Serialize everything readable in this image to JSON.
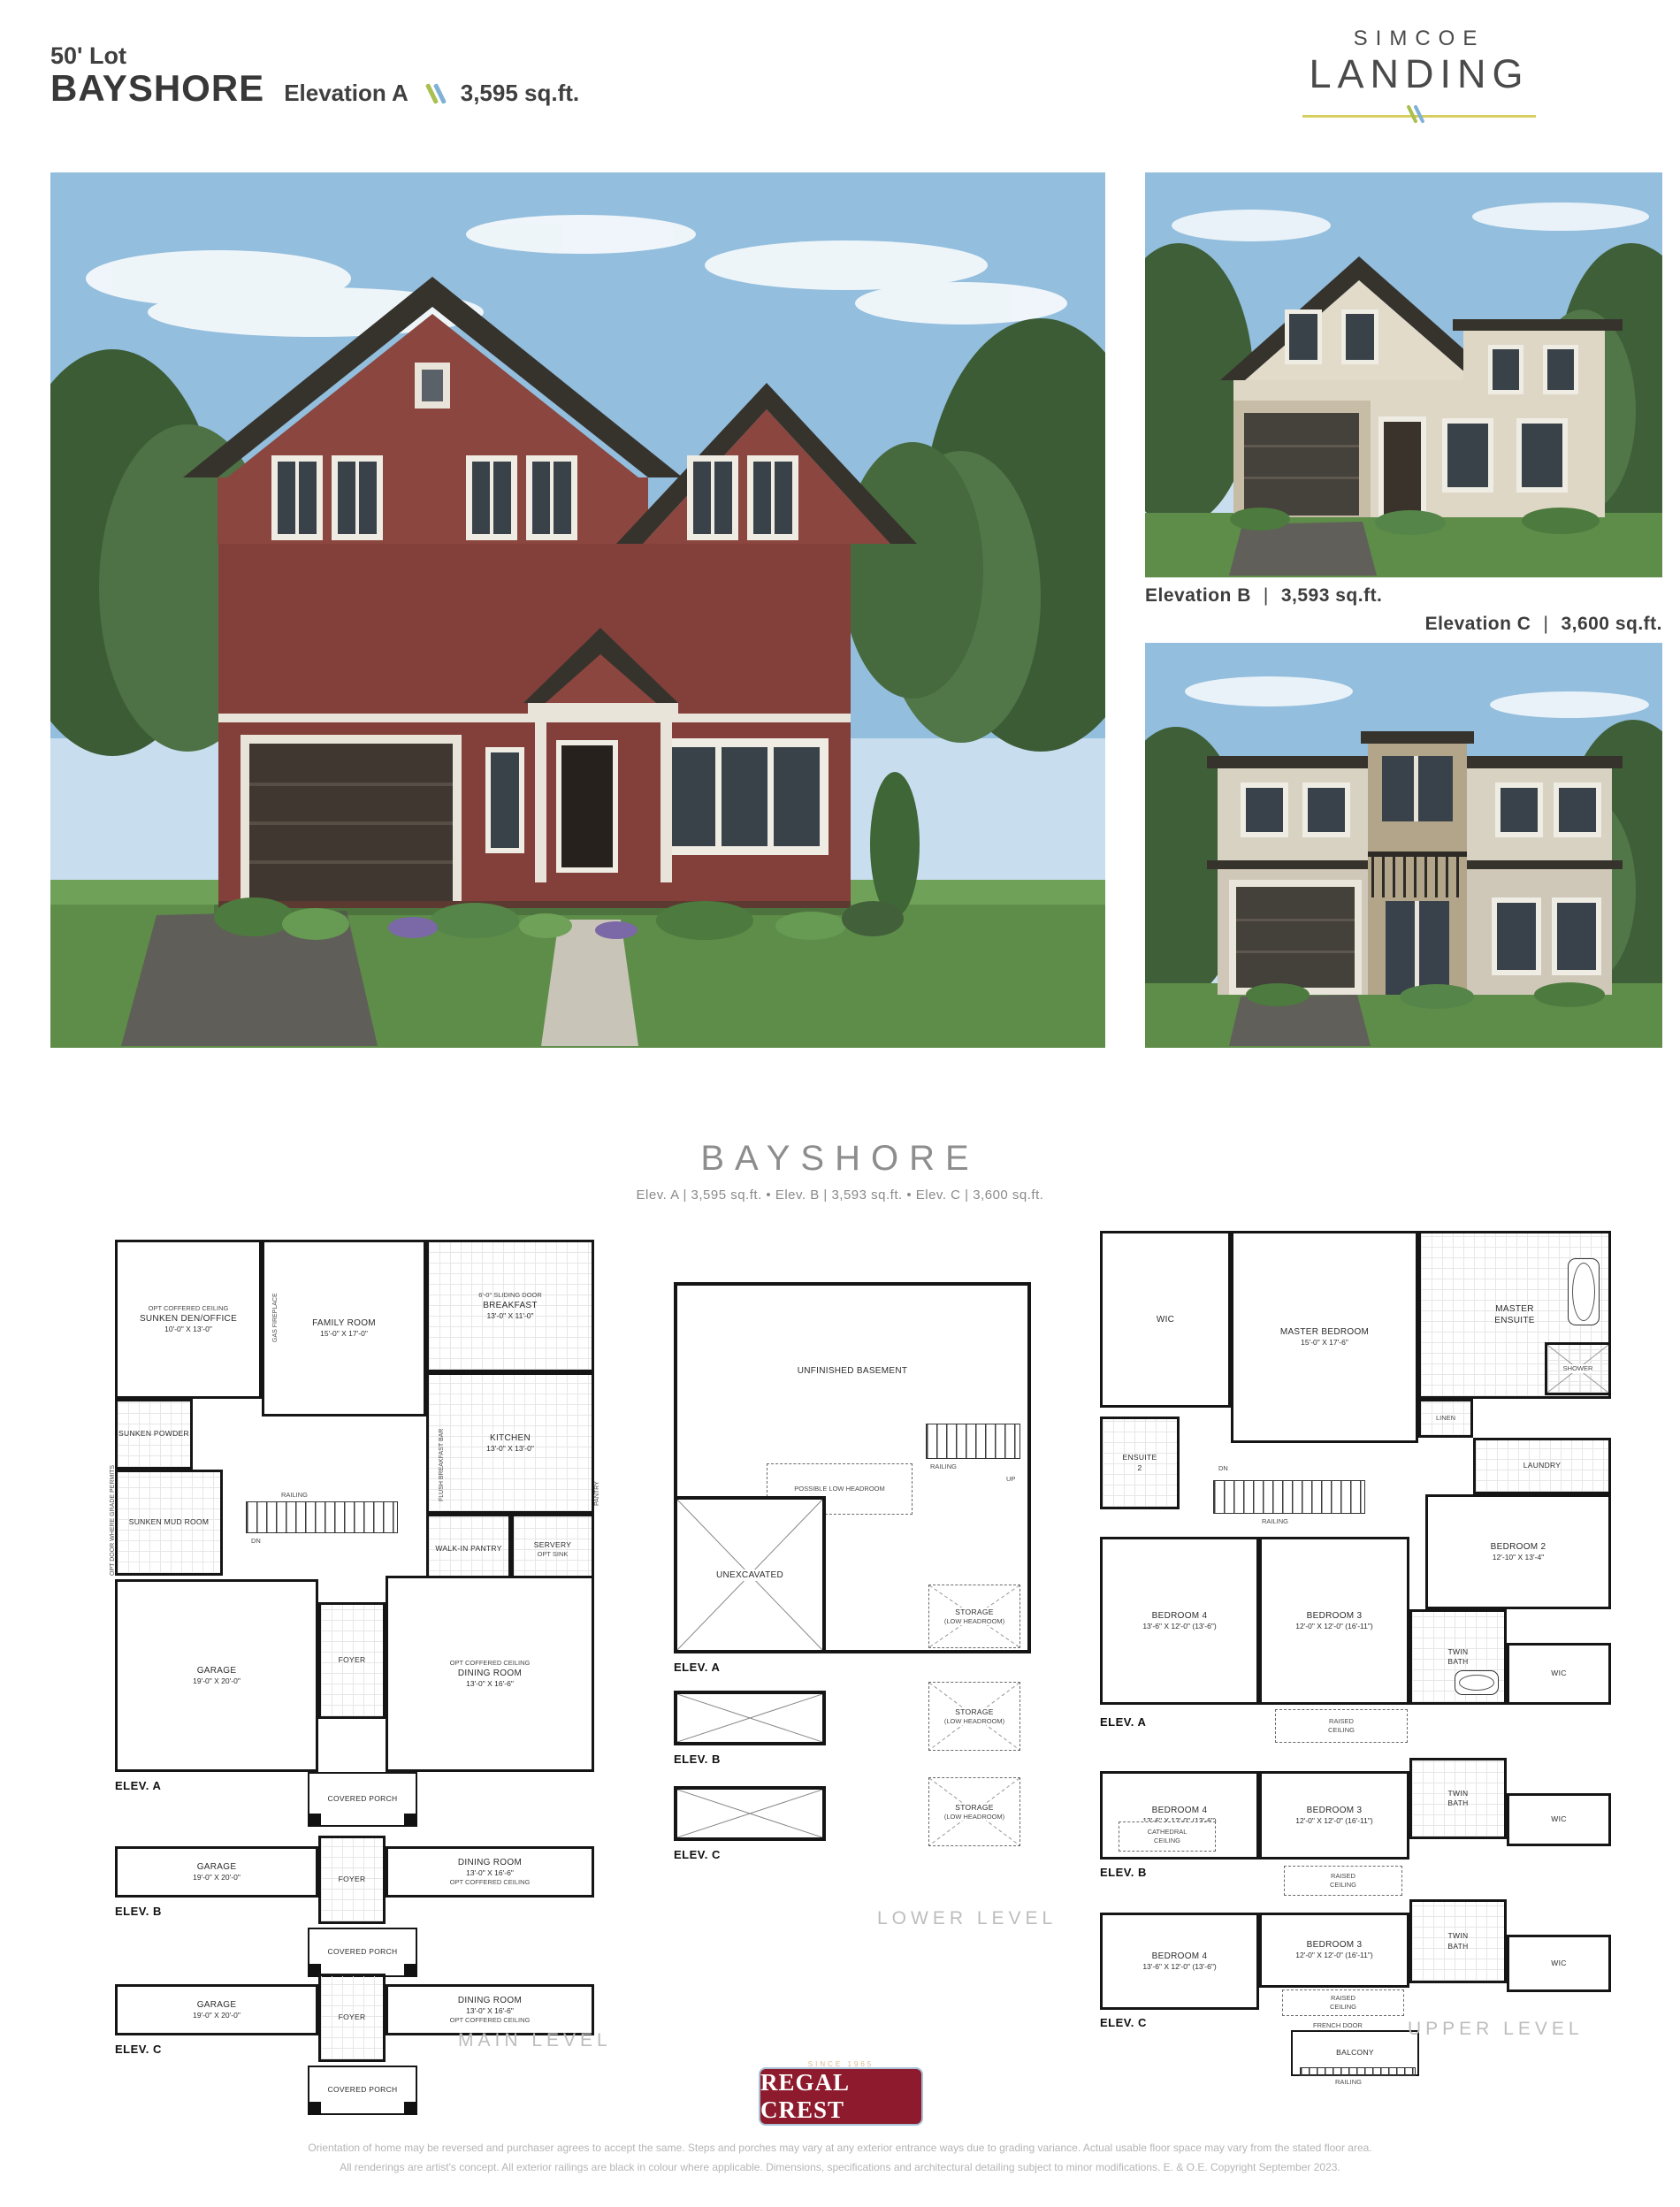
{
  "header": {
    "lot": "50' Lot",
    "model": "BAYSHORE",
    "elevation": "Elevation A",
    "sqft": "3,595 sq.ft."
  },
  "brand": {
    "top": "SIMCOE",
    "bottom": "LANDING"
  },
  "captions": {
    "b_name": "Elevation B",
    "b_sqft": "3,593 sq.ft.",
    "c_name": "Elevation C",
    "c_sqft": "3,600 sq.ft.",
    "sep": "|"
  },
  "section": {
    "title": "BAYSHORE",
    "subtitle": "Elev. A  |  3,595 sq.ft.   •   Elev. B  |  3,593 sq.ft.   •   Elev. C  |  3,600 sq.ft."
  },
  "levels": {
    "main": "MAIN LEVEL",
    "lower": "LOWER LEVEL",
    "upper": "UPPER LEVEL"
  },
  "elev_labels": {
    "a": "ELEV. A",
    "b": "ELEV. B",
    "c": "ELEV. C"
  },
  "main": {
    "den": {
      "name": "SUNKEN DEN/OFFICE",
      "dims": "10'-0\" X 13'-0\""
    },
    "family": {
      "name": "FAMILY ROOM",
      "dims": "15'-0\" X 17'-0\""
    },
    "breakfast": {
      "name": "BREAKFAST",
      "dims": "13'-0\" X 11'-0\""
    },
    "kitchen": {
      "name": "KITCHEN",
      "dims": "13'-0\" X 13'-0\""
    },
    "powder": "SUNKEN POWDER",
    "mud": "SUNKEN MUD ROOM",
    "walkin": "WALK-IN PANTRY",
    "servery": "SERVERY",
    "opt_sink": "OPT SINK",
    "pantry": "PANTRY",
    "garage": {
      "name": "GARAGE",
      "dims": "19'-0\" X 20'-0\""
    },
    "dining": {
      "name": "DINING ROOM",
      "dims": "13'-0\" X 16'-6\""
    },
    "foyer": "FOYER",
    "porch": "COVERED PORCH",
    "railing": "RAILING",
    "dn": "DN",
    "notes": {
      "coffered": "OPT COFFERED CEILING",
      "sliding": "6'-0\" SLIDING DOOR",
      "fireplace": "GAS FIREPLACE",
      "bar": "FLUSH BREAKFAST BAR",
      "door_grade": "DOOR WHERE GRADE PERMITS",
      "opt_door_grade": "OPT DOOR WHERE GRADE PERMITS"
    }
  },
  "lower": {
    "basement": "UNFINISHED BASEMENT",
    "low_head": "POSSIBLE LOW HEADROOM",
    "unexcavated": "UNEXCAVATED",
    "storage": "STORAGE",
    "storage_sub": "(LOW HEADROOM)",
    "railing": "RAILING",
    "up": "UP"
  },
  "upper": {
    "wic": "WIC",
    "master": {
      "name": "MASTER BEDROOM",
      "dims": "15'-0\" X 17'-6\""
    },
    "ensuite": {
      "line1": "MASTER",
      "line2": "ENSUITE"
    },
    "shower": "SHOWER",
    "linen": "LINEN",
    "laundry": "LAUNDRY",
    "ensuite2": {
      "line1": "ENSUITE",
      "line2": "2"
    },
    "bed2": {
      "name": "BEDROOM 2",
      "dims": "12'-10\" X 13'-4\""
    },
    "bed3": {
      "name": "BEDROOM 3",
      "dims": "12'-0\" X 12'-0\" (16'-11\")"
    },
    "bed4": {
      "name": "BEDROOM 4",
      "dims": "13'-6\" X 12'-0\" (13'-6\")"
    },
    "twin": {
      "line1": "TWIN",
      "line2": "BATH"
    },
    "raised": {
      "line1": "RAISED",
      "line2": "CEILING"
    },
    "cathedral": {
      "line1": "CATHEDRAL",
      "line2": "CEILING"
    },
    "french": "FRENCH DOOR",
    "balcony": "BALCONY",
    "railing": "RAILING",
    "dn": "DN"
  },
  "footer": {
    "since": "SINCE 1965",
    "brand": "REGAL CREST",
    "homes": "HOMES",
    "disclaimer1": "Orientation of home may be reversed and purchaser agrees to accept the same. Steps and porches may vary at any exterior entrance ways due to grading variance. Actual usable floor space may vary from the stated floor area.",
    "disclaimer2": "All renderings are artist's concept. All exterior railings are black in colour where applicable. Dimensions, specifications and architectural detailing subject to minor modifications. E. & O.E. Copyright September 2023."
  },
  "colors": {
    "accent_blue": "#7fb1d4",
    "accent_green": "#a9bf4f",
    "accent_yellow": "#d6ce5e",
    "regal_red": "#8d1b2d",
    "brick": "#83403a",
    "ink": "#151515"
  }
}
